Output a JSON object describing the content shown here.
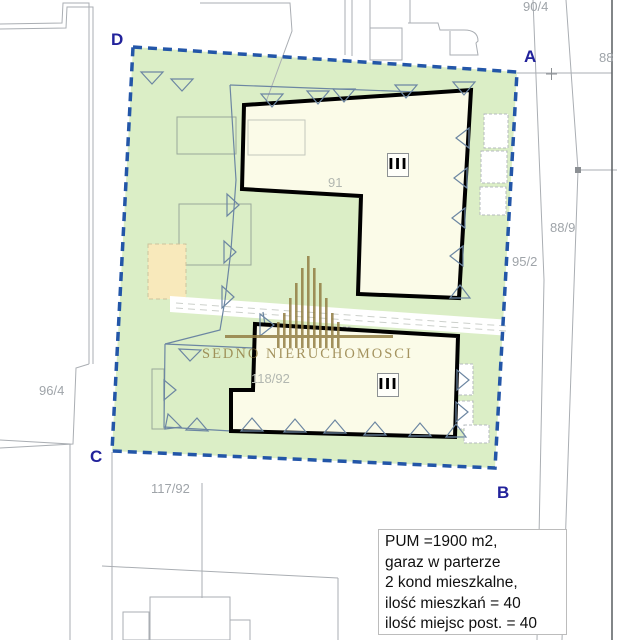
{
  "map": {
    "corner_labels": {
      "a": "A",
      "b": "B",
      "c": "C",
      "d": "D"
    },
    "parcel_labels": {
      "p90_4": "90/4",
      "p88": "88",
      "p88_9": "88/9",
      "p95_2": "95/2",
      "p96_4": "96/4",
      "p117_92": "117/92",
      "p118_92": "118/92",
      "p91": "91"
    },
    "buildings": {
      "top": {
        "storeys": "III"
      },
      "bottom": {
        "storeys": "III"
      }
    }
  },
  "watermark": {
    "text": "SEDNO NIERUCHOMOSCI",
    "icon": "organ-bars-logo"
  },
  "info_box": {
    "lines": [
      "PUM =1900 m2,",
      "garaz w parterze",
      "2 kond mieszkalne,",
      "ilość mieszkań = 40",
      "ilość miejsc post. = 40"
    ]
  },
  "colors": {
    "site_green": "#dbeec6",
    "building_fill": "#fbfbe8",
    "boundary_blue": "#2356a8",
    "corner_navy": "#22229b",
    "logo_gold": "#8f7a3e",
    "parcel_label_gray": "#9fa4a9"
  }
}
